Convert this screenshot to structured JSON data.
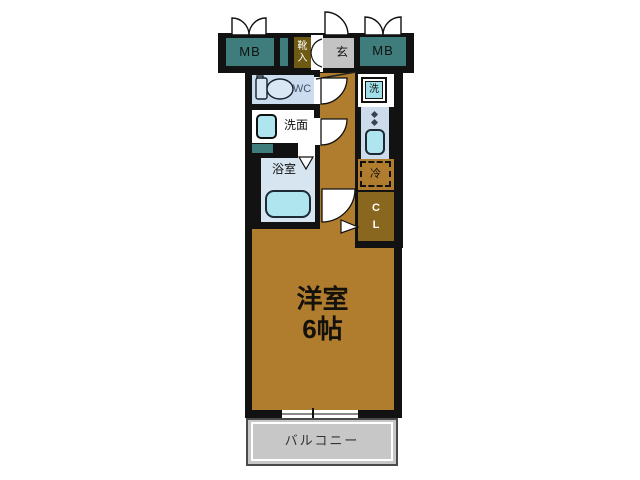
{
  "plan": {
    "kind": "japanese-apartment-floor-plan",
    "labels": {
      "mb_left": "MB",
      "mb_right": "MB",
      "shoe_cabinet": "靴\n入",
      "entrance": "玄",
      "toilet": "WC",
      "washroom": "洗面",
      "bathroom": "浴室",
      "laundry": "洗",
      "fridge": "冷",
      "closet": "C\nL",
      "main_room": "洋室\n6帖",
      "balcony": "バルコニー"
    },
    "colors": {
      "wall": "#121212",
      "teal": "#3e7d7b",
      "olive": "#6e5a13",
      "genkan_gray": "#c3c3c3",
      "room_brown": "#b07d2e",
      "closet_brown": "#8a671f",
      "wc_bg": "#ccdcef",
      "bath_bg": "#d7e5f0",
      "fixture_cyan": "#aee5ef",
      "laundry_cyan": "#9fdfe8",
      "kitchen_bg": "#ccdcec",
      "balcony_gray": "#c7c7c7",
      "window_line": "#8a8a8a"
    }
  }
}
